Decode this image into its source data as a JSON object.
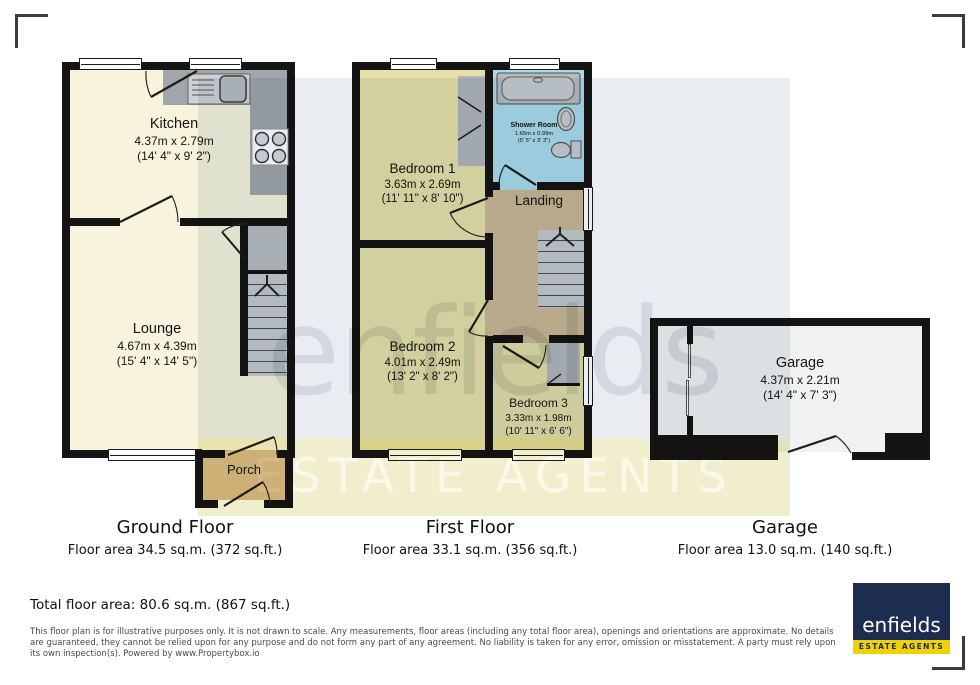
{
  "watermark": {
    "brand": "enfields",
    "tagline": "ESTATE AGENTS"
  },
  "plans": {
    "ground": {
      "title": "Ground Floor",
      "area_caption": "Floor area 34.5 sq.m. (372 sq.ft.)",
      "rooms": {
        "kitchen": {
          "name": "Kitchen",
          "metric": "4.37m x 2.79m",
          "imperial": "(14' 4\" x 9' 2\")"
        },
        "lounge": {
          "name": "Lounge",
          "metric": "4.67m x 4.39m",
          "imperial": "(15' 4\" x 14' 5\")"
        },
        "porch": {
          "name": "Porch"
        }
      }
    },
    "first": {
      "title": "First Floor",
      "area_caption": "Floor area 33.1 sq.m. (356 sq.ft.)",
      "rooms": {
        "bedroom1": {
          "name": "Bedroom 1",
          "metric": "3.63m x 2.69m",
          "imperial": "(11' 11\" x 8' 10\")"
        },
        "bedroom2": {
          "name": "Bedroom 2",
          "metric": "4.01m x 2.49m",
          "imperial": "(13' 2\" x 8' 2\")"
        },
        "bedroom3": {
          "name": "Bedroom 3",
          "metric": "3.33m x 1.98m",
          "imperial": "(10' 11\" x 6' 6\")"
        },
        "shower": {
          "name": "Shower Room",
          "metric": "1.65m x 0.99m",
          "imperial": "(5' 5\" x 3' 3\")"
        },
        "landing": {
          "name": "Landing"
        }
      }
    },
    "garage": {
      "title": "Garage",
      "area_caption": "Floor area 13.0 sq.m. (140 sq.ft.)",
      "rooms": {
        "garage": {
          "name": "Garage",
          "metric": "4.37m x 2.21m",
          "imperial": "(14' 4\" x 7' 3\")"
        }
      }
    }
  },
  "summary": {
    "total_caption": "Total floor area: 80.6 sq.m. (867 sq.ft.)"
  },
  "disclaimer": "This floor plan is for illustrative purposes only. It is not drawn to scale. Any measurements, floor areas (including any total floor area), openings and orientations are approximate. No details are guaranteed, they cannot be relied upon for any purpose and do not form any part of any agreement. No liability is taken for any error, omission or misstatement. A party must rely upon its own inspection(s). Powered by www.Propertybox.io",
  "logo": {
    "brand": "enfields",
    "tagline": "ESTATE AGENTS"
  },
  "colors": {
    "brand_navy": "#1d2d52",
    "brand_yellow": "#f0d103",
    "wall_black": "#141414",
    "ground_floor_fill": "#f7f3dc",
    "bedroom_fill": "#e6e0a8",
    "landing_fill": "#c9b691",
    "porch_fill": "#d9bd92",
    "shower_fill": "#a9dcea",
    "counter_gray": "#a0a6a9"
  }
}
